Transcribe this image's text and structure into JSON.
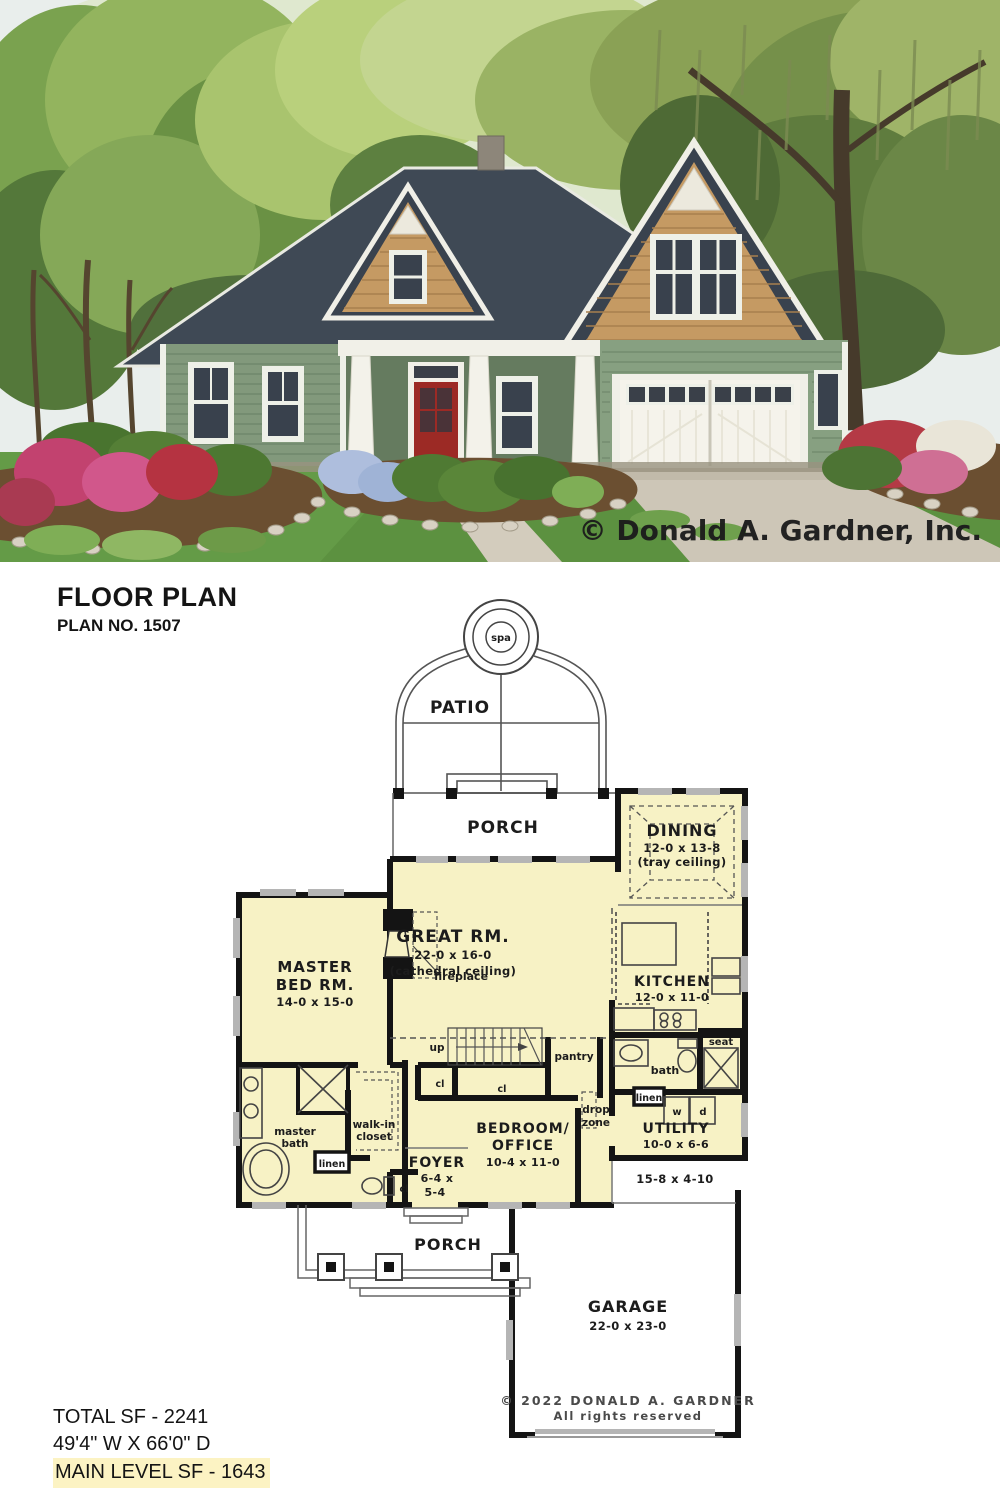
{
  "photo": {
    "watermark": "© Donald A. Gardner, Inc."
  },
  "header": {
    "title": "FLOOR PLAN",
    "plan_no": "PLAN NO. 1507"
  },
  "rooms": {
    "spa": {
      "name": "spa"
    },
    "patio": {
      "name": "PATIO"
    },
    "rear_porch": {
      "name": "PORCH"
    },
    "dining": {
      "name": "DINING",
      "dims": "12-0 x 13-8",
      "note": "(tray ceiling)"
    },
    "great_room": {
      "name": "GREAT RM.",
      "dims": "22-0 x 16-0",
      "note": "(cathedral ceiling)"
    },
    "kitchen": {
      "name": "KITCHEN",
      "dims": "12-0 x 11-0"
    },
    "master_bedroom": {
      "name_line1": "MASTER",
      "name_line2": "BED RM.",
      "dims": "14-0 x 15-0"
    },
    "master_bath": {
      "name_line1": "master",
      "name_line2": "bath"
    },
    "walk_in_closet": {
      "name_line1": "walk-in",
      "name_line2": "closet"
    },
    "foyer": {
      "name": "FOYER",
      "dims_line1": "6-4 x",
      "dims_line2": "5-4"
    },
    "bedroom_office": {
      "name_line1": "BEDROOM/",
      "name_line2": "OFFICE",
      "dims": "10-4 x 11-0"
    },
    "bath": {
      "name": "bath"
    },
    "utility": {
      "name": "UTILITY",
      "dims": "10-0 x 6-6"
    },
    "stoop": {
      "dims": "15-8 x 4-10"
    },
    "front_porch": {
      "name": "PORCH"
    },
    "garage": {
      "name": "GARAGE",
      "dims": "22-0 x 23-0"
    }
  },
  "small_labels": {
    "fireplace": "fireplace",
    "up": "up",
    "pantry": "pantry",
    "cl": "cl",
    "seat": "seat",
    "linen": "linen",
    "washer": "w",
    "dryer": "d",
    "drop_line1": "drop",
    "drop_line2": "zone"
  },
  "copyright": {
    "line1": "© 2022 DONALD A. GARDNER",
    "line2": "All rights reserved"
  },
  "summary": {
    "total_sf": "TOTAL SF - 2241",
    "dimensions": "49'4\" W X 66'0\" D",
    "main_level_sf": "MAIN LEVEL SF - 1643"
  }
}
